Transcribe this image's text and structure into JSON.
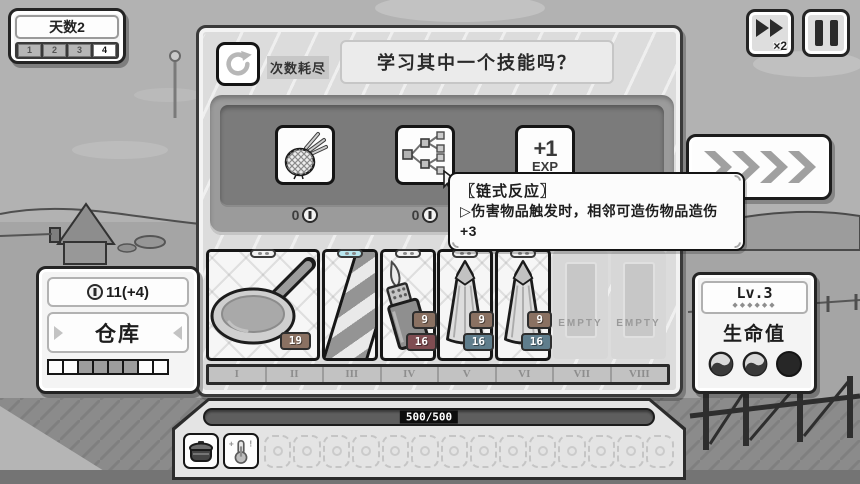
{
  "colors": {
    "badge_brown": "#8a7162",
    "badge_red": "#7f4d52",
    "badge_blue": "#5f7d8c",
    "pill_cyan": "#b9e7f0",
    "pill_white": "#f2f2f2"
  },
  "day_panel": {
    "title": "天数2",
    "tabs": [
      "1",
      "2",
      "3",
      "4"
    ],
    "active_tab": "4"
  },
  "top_controls": {
    "speed_label": "×2"
  },
  "dialog": {
    "status_label": "次数耗尽",
    "question": "学习其中一个技能吗？",
    "skills": [
      {
        "icon": "onion-skill",
        "price": "0"
      },
      {
        "icon": "chain-reaction-skill",
        "price": "0"
      },
      {
        "icon": "exp-skill",
        "line1": "+1",
        "line2": "EXP"
      }
    ]
  },
  "tooltip": {
    "title": "〖链式反应〗",
    "body": "▷伤害物品触发时，相邻可造伤物品造伤+3"
  },
  "cards": {
    "slot_labels": [
      "I",
      "II",
      "III",
      "IV",
      "V",
      "VI",
      "VII",
      "VIII"
    ],
    "items": [
      {
        "icon": "frying-pan",
        "badge": "19"
      },
      {
        "icon": "striped-pole"
      },
      {
        "icon": "lighter",
        "badge_top": "9",
        "badge_bottom": "16"
      },
      {
        "icon": "salt-bag",
        "badge_top": "9",
        "badge_bottom": "16"
      },
      {
        "icon": "salt-bag",
        "badge_top": "9",
        "badge_bottom": "16"
      },
      {
        "label": "EMPTY"
      },
      {
        "label": "EMPTY"
      }
    ]
  },
  "warehouse_panel": {
    "coins": "11(+4)",
    "label": "仓库",
    "segments": [
      "empty",
      "empty",
      "filled",
      "filled",
      "filled",
      "filled",
      "empty",
      "empty"
    ]
  },
  "status_panel": {
    "level": "Lv.3",
    "pips": "◆◆◆◆◆◆",
    "hp_label": "生命值",
    "orbs": [
      "alive",
      "alive",
      "lost"
    ]
  },
  "bottom_bar": {
    "hp": "500/500"
  }
}
